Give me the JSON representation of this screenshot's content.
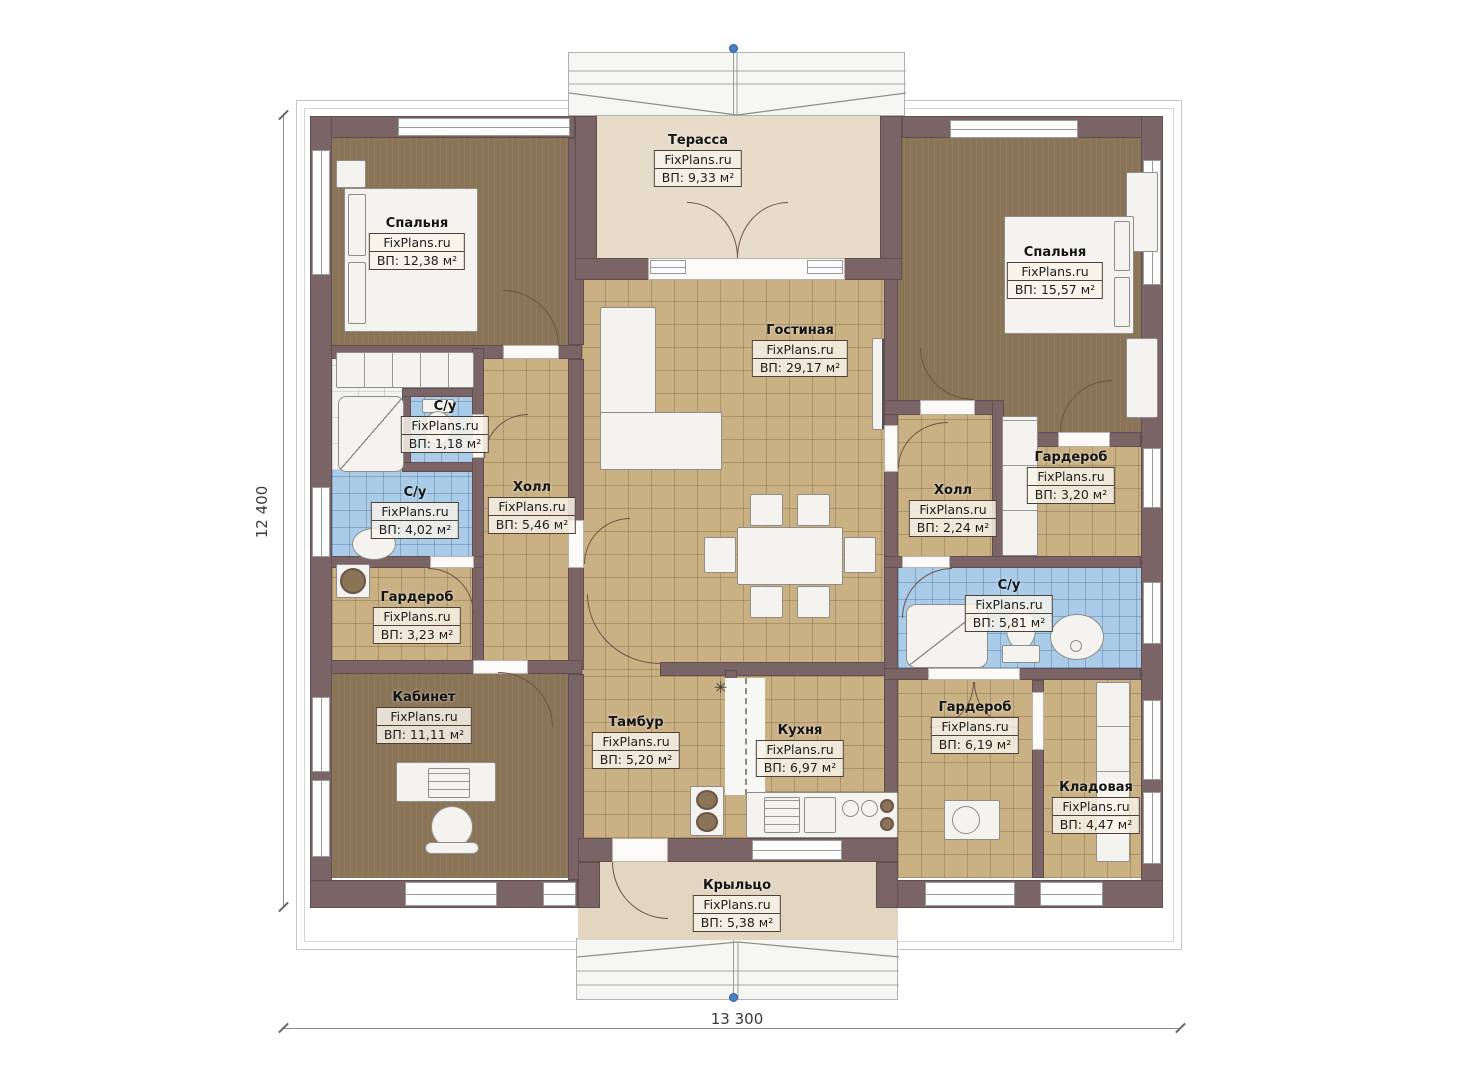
{
  "watermark": "FixPlans.ru",
  "dimensions": {
    "height_label": "12 400",
    "width_label": "13 300"
  },
  "symbols": {
    "asterisk": "✳"
  },
  "colors": {
    "wall": "#7a6466",
    "floor_tile": "#c9b184",
    "floor_bath": "#aacce8",
    "floor_room": "#8a7457",
    "floor_terrace": "#e7dcc9",
    "accent_dot": "#4a7fc1"
  },
  "rooms": [
    {
      "name": "Терасса",
      "area": "ВП: 9,33 м²"
    },
    {
      "name": "Спальня",
      "area": "ВП: 12,38 м²"
    },
    {
      "name": "Спальня",
      "area": "ВП: 15,57 м²"
    },
    {
      "name": "Гостиная",
      "area": "ВП: 29,17 м²"
    },
    {
      "name": "С/у",
      "area": "ВП: 1,18 м²"
    },
    {
      "name": "С/у",
      "area": "ВП: 4,02 м²"
    },
    {
      "name": "Холл",
      "area": "ВП: 5,46 м²"
    },
    {
      "name": "Гардероб",
      "area": "ВП: 3,23 м²"
    },
    {
      "name": "Кабинет",
      "area": "ВП: 11,11 м²"
    },
    {
      "name": "Тамбур",
      "area": "ВП: 5,20 м²"
    },
    {
      "name": "Кухня",
      "area": "ВП: 6,97 м²"
    },
    {
      "name": "Холл",
      "area": "ВП: 2,24 м²"
    },
    {
      "name": "Гардероб",
      "area": "ВП: 3,20 м²"
    },
    {
      "name": "С/у",
      "area": "ВП: 5,81 м²"
    },
    {
      "name": "Гардероб",
      "area": "ВП: 6,19 м²"
    },
    {
      "name": "Кладовая",
      "area": "ВП: 4,47 м²"
    },
    {
      "name": "Крыльцо",
      "area": "ВП: 5,38 м²"
    }
  ]
}
